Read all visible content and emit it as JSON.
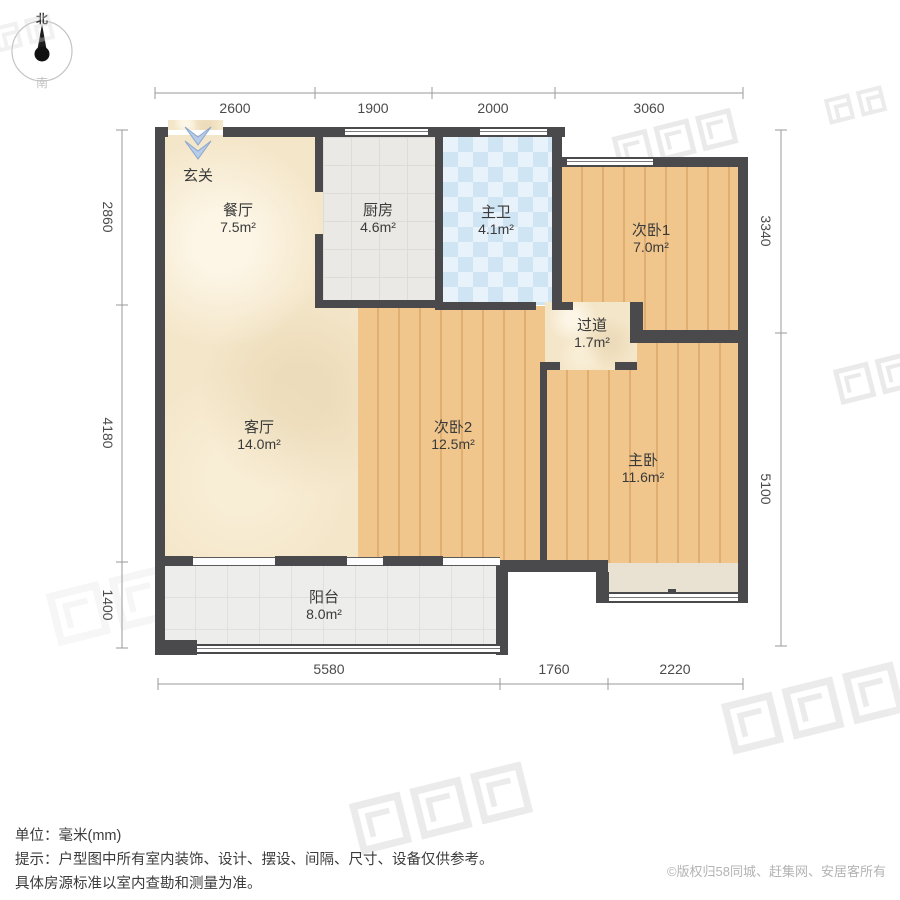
{
  "compass": {
    "north": "北",
    "south": "南"
  },
  "dims": {
    "top": [
      "2600",
      "1900",
      "2000",
      "3060"
    ],
    "bottom": [
      "5580",
      "1760",
      "2220"
    ],
    "left": [
      "2860",
      "4180",
      "1400"
    ],
    "right": [
      "3340",
      "5100"
    ]
  },
  "rooms": [
    {
      "name": "玄关",
      "area": ""
    },
    {
      "name": "餐厅",
      "area": "7.5m²"
    },
    {
      "name": "厨房",
      "area": "4.6m²"
    },
    {
      "name": "主卫",
      "area": "4.1m²"
    },
    {
      "name": "次卧1",
      "area": "7.0m²"
    },
    {
      "name": "过道",
      "area": "1.7m²"
    },
    {
      "name": "客厅",
      "area": "14.0m²"
    },
    {
      "name": "次卧2",
      "area": "12.5m²"
    },
    {
      "name": "主卧",
      "area": "11.6m²"
    },
    {
      "name": "阳台",
      "area": "8.0m²"
    }
  ],
  "footer": {
    "unit_line": "单位：毫米(mm)",
    "tip_line1": "提示：户型图中所有室内装饰、设计、摆设、间隔、尺寸、设备仅供参考。",
    "tip_line2": "具体房源标准以室内查勘和测量为准。",
    "copyright": "©版权归58同城、赶集网、安居客所有"
  }
}
